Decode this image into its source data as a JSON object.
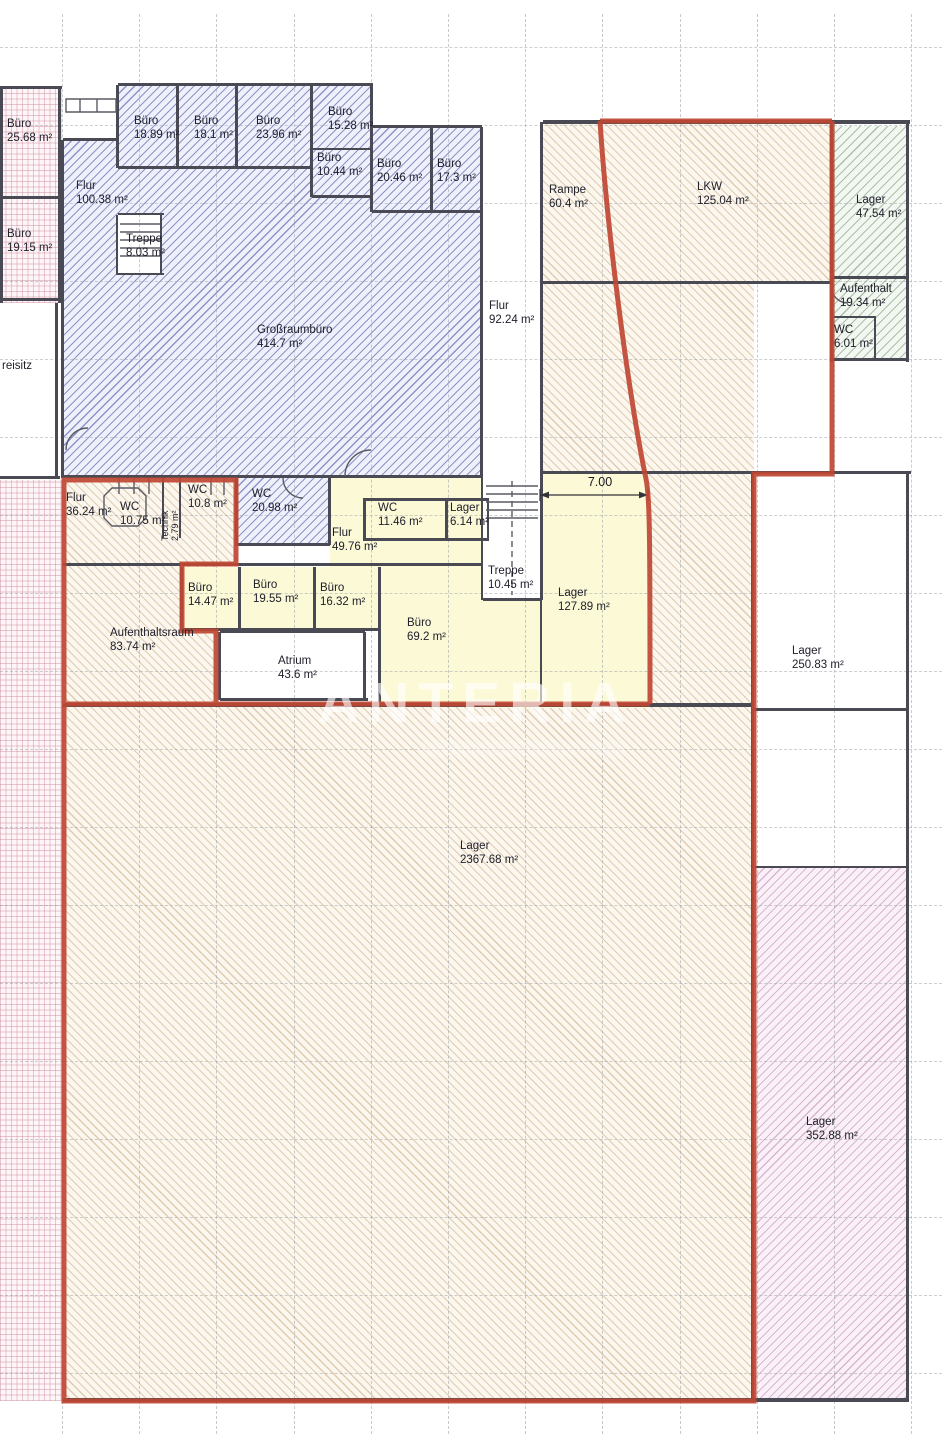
{
  "watermark": {
    "text": "ANTERIA"
  },
  "dimension": {
    "label": "7.00"
  },
  "colors": {
    "boundary_red": "#bf4733",
    "wall_gray": "#4a4a55",
    "blue_hatch": "#565ca4",
    "tan_hatch": "#c6a074",
    "green_hatch": "#6e916c",
    "pink_grid": "#c67c90",
    "pink_diag": "#bc7aac",
    "yellow_fill": "#fbf9d6"
  },
  "rooms": [
    {
      "name": "Büro",
      "area": "25.68 m²",
      "x": 7,
      "y": 118
    },
    {
      "name": "Büro",
      "area": "19.15 m²",
      "x": 7,
      "y": 228
    },
    {
      "name": "Flur",
      "area": "100.38 m²",
      "x": 76,
      "y": 180
    },
    {
      "name": "Treppe",
      "area": "8.03 m²",
      "x": 126,
      "y": 233
    },
    {
      "name": "Büro",
      "area": "18.89 m²",
      "x": 134,
      "y": 115
    },
    {
      "name": "Büro",
      "area": "18.1 m²",
      "x": 194,
      "y": 115
    },
    {
      "name": "Büro",
      "area": "23.96 m²",
      "x": 256,
      "y": 115
    },
    {
      "name": "Büro",
      "area": "15.28 m²",
      "x": 328,
      "y": 106
    },
    {
      "name": "Büro",
      "area": "10.44 m²",
      "x": 317,
      "y": 152
    },
    {
      "name": "Büro",
      "area": "20.46 m²",
      "x": 377,
      "y": 158
    },
    {
      "name": "Büro",
      "area": "17.3 m²",
      "x": 437,
      "y": 158
    },
    {
      "name": "Großraumbüro",
      "area": "414.7 m²",
      "x": 257,
      "y": 324
    },
    {
      "name": "Flur",
      "area": "92.24 m²",
      "x": 489,
      "y": 300
    },
    {
      "name": "Rampe",
      "area": "60.4 m²",
      "x": 549,
      "y": 184
    },
    {
      "name": "LKW",
      "area": "125.04 m²",
      "x": 697,
      "y": 181
    },
    {
      "name": "Lager",
      "area": "47.54 m²",
      "x": 856,
      "y": 194
    },
    {
      "name": "Aufenthalt",
      "area": "19.34 m²",
      "x": 840,
      "y": 283
    },
    {
      "name": "WC",
      "area": "6.01 m²",
      "x": 834,
      "y": 324
    },
    {
      "name": "reisitz",
      "area": "",
      "x": 2,
      "y": 360
    },
    {
      "name": "Flur",
      "area": "36.24 m²",
      "x": 66,
      "y": 492
    },
    {
      "name": "WC",
      "area": "10.75 m²",
      "x": 120,
      "y": 501
    },
    {
      "name": "Technik",
      "area": "2.79 m²",
      "x": 160,
      "y": 541,
      "cls": "vert"
    },
    {
      "name": "WC",
      "area": "10.8 m²",
      "x": 188,
      "y": 484
    },
    {
      "name": "WC",
      "area": "20.98 m²",
      "x": 252,
      "y": 488
    },
    {
      "name": "Flur",
      "area": "49.76 m²",
      "x": 332,
      "y": 527
    },
    {
      "name": "WC",
      "area": "11.46 m²",
      "x": 378,
      "y": 502
    },
    {
      "name": "Lager",
      "area": "6.14 m²",
      "x": 450,
      "y": 502
    },
    {
      "name": "Treppe",
      "area": "10.45 m²",
      "x": 488,
      "y": 565
    },
    {
      "name": "Lager",
      "area": "127.89 m²",
      "x": 558,
      "y": 587
    },
    {
      "name": "Büro",
      "area": "14.47 m²",
      "x": 188,
      "y": 582
    },
    {
      "name": "Büro",
      "area": "19.55 m²",
      "x": 253,
      "y": 579
    },
    {
      "name": "Büro",
      "area": "16.32 m²",
      "x": 320,
      "y": 582
    },
    {
      "name": "Büro",
      "area": "69.2 m²",
      "x": 407,
      "y": 617
    },
    {
      "name": "Aufenthaltsraum",
      "area": "83.74 m²",
      "x": 110,
      "y": 627
    },
    {
      "name": "Atrium",
      "area": "43.6 m²",
      "x": 278,
      "y": 655
    },
    {
      "name": "Lager",
      "area": "250.83 m²",
      "x": 792,
      "y": 645
    },
    {
      "name": "Lager",
      "area": "2367.68 m²",
      "x": 460,
      "y": 840
    },
    {
      "name": "Lager",
      "area": "352.88 m²",
      "x": 806,
      "y": 1116
    }
  ]
}
